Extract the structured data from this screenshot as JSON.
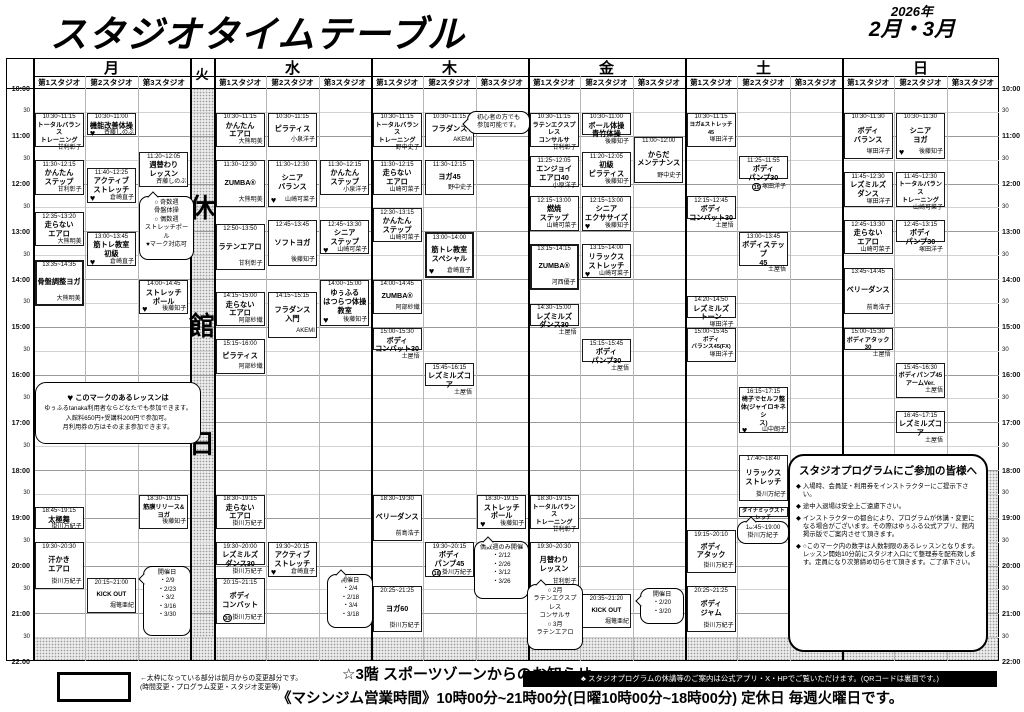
{
  "header": {
    "title": "スタジオタイムテーブル",
    "year": "2026年",
    "months": "2月・3月"
  },
  "timetable": {
    "studio_labels": [
      "第1スタジオ",
      "第2スタジオ",
      "第3スタジオ"
    ],
    "days": [
      "月",
      "火",
      "水",
      "木",
      "金",
      "土",
      "日"
    ],
    "closed_day": "火",
    "closed_day_label": "休館日",
    "time_labels": [
      "10:00",
      "30",
      "11:00",
      "30",
      "12:00",
      "30",
      "13:00",
      "30",
      "14:00",
      "30",
      "15:00",
      "30",
      "16:00",
      "30",
      "17:00",
      "30",
      "18:00",
      "30",
      "19:00",
      "30",
      "20:00",
      "30",
      "21:00",
      "30",
      "22:00"
    ],
    "classes": [
      {
        "day": "月",
        "studio": 1,
        "time": "10:30~11:15",
        "name": [
          "トータルバランス",
          "トレーニング"
        ],
        "teacher": "甘利彰子"
      },
      {
        "day": "月",
        "studio": 1,
        "time": "11:30~12:15",
        "name": [
          "かんたん",
          "ステップ"
        ],
        "teacher": "甘利彰子"
      },
      {
        "day": "月",
        "studio": 1,
        "time": "12:35~13:20",
        "name": [
          "走らない",
          "エアロ"
        ],
        "teacher": "大熊明美"
      },
      {
        "day": "月",
        "studio": 1,
        "time": "13:35~14:35",
        "name": [
          "骨盤調整ヨガ"
        ],
        "teacher": "大熊明美",
        "bold": true
      },
      {
        "day": "月",
        "studio": 1,
        "time": "18:45~19:15",
        "name": [
          "太極舞"
        ],
        "teacher": "掛川万紀子"
      },
      {
        "day": "月",
        "studio": 1,
        "time": "19:30~20:30",
        "name": [
          "汗かき",
          "エアロ"
        ],
        "teacher": "掛川万紀子"
      },
      {
        "day": "月",
        "studio": 2,
        "time": "10:30~11:00",
        "name": [
          "機能改善体操"
        ],
        "teacher": "斉藤しのぶ",
        "heart": true
      },
      {
        "day": "月",
        "studio": 2,
        "time": "11:40~12:25",
        "name": [
          "アクティブ",
          "ストレッチ"
        ],
        "teacher": "倉崎直子",
        "heart": true
      },
      {
        "day": "月",
        "studio": 2,
        "time": "13:00~13:45",
        "name": [
          "筋トレ教室",
          "初級"
        ],
        "teacher": "倉崎直子",
        "heart": true
      },
      {
        "day": "月",
        "studio": 2,
        "time": "20:15~21:00",
        "name": [
          "KICK OUT"
        ],
        "teacher": "堀篭亜紀"
      },
      {
        "day": "月",
        "studio": 3,
        "time": "11:20~12:05",
        "name": [
          "週替わり",
          "レッスン"
        ],
        "teacher": "斉藤しのぶ"
      },
      {
        "day": "月",
        "studio": 3,
        "time": "14:00~14:45",
        "name": [
          "ストレッチ",
          "ポール"
        ],
        "teacher": "後藤知子",
        "heart": true
      },
      {
        "day": "月",
        "studio": 3,
        "time": "18:30~19:15",
        "name": [
          "筋膜リリース&ヨガ"
        ],
        "teacher": "後藤知子"
      },
      {
        "day": "水",
        "studio": 1,
        "time": "10:30~11:15",
        "name": [
          "かんたん",
          "エアロ"
        ],
        "teacher": "大熊明美"
      },
      {
        "day": "水",
        "studio": 1,
        "time": "11:30~12:30",
        "name": [
          "ZUMBA®"
        ],
        "teacher": "大熊明美"
      },
      {
        "day": "水",
        "studio": 1,
        "time": "12:50~13:50",
        "name": [
          "ラテンエアロ"
        ],
        "teacher": "甘利彰子"
      },
      {
        "day": "水",
        "studio": 1,
        "time": "14:15~15:00",
        "name": [
          "走らない",
          "エアロ"
        ],
        "teacher": "阿部紗織"
      },
      {
        "day": "水",
        "studio": 1,
        "time": "15:15~16:00",
        "name": [
          "ピラティス"
        ],
        "teacher": "阿部紗織"
      },
      {
        "day": "水",
        "studio": 1,
        "time": "18:30~19:15",
        "name": [
          "走らない",
          "エアロ"
        ],
        "teacher": "掛川万紀子"
      },
      {
        "day": "水",
        "studio": 1,
        "time": "19:30~20:00",
        "name": [
          "レズミルズ",
          "ダンス30"
        ],
        "teacher": "掛川万紀子"
      },
      {
        "day": "水",
        "studio": 1,
        "time": "20:15~21:15",
        "name": [
          "ボディ",
          "コンバット"
        ],
        "teacher": "掛川万紀子",
        "cap": 30
      },
      {
        "day": "水",
        "studio": 2,
        "time": "10:30~11:15",
        "name": [
          "ピラティス"
        ],
        "teacher": "小泉洋子"
      },
      {
        "day": "水",
        "studio": 2,
        "time": "11:30~12:30",
        "name": [
          "シニア",
          "バランス"
        ],
        "teacher": "山崎可菜子",
        "heart": true
      },
      {
        "day": "水",
        "studio": 2,
        "time": "12:45~13:45",
        "name": [
          "ソフトヨガ"
        ],
        "teacher": "後藤知子"
      },
      {
        "day": "水",
        "studio": 2,
        "time": "14:15~15:15",
        "name": [
          "フラダンス",
          "入門"
        ],
        "teacher": "AKEMI"
      },
      {
        "day": "水",
        "studio": 2,
        "time": "19:30~20:15",
        "name": [
          "アクティブ",
          "ストレッチ"
        ],
        "teacher": "倉崎直子",
        "heart": true
      },
      {
        "day": "水",
        "studio": 3,
        "time": "11:30~12:15",
        "name": [
          "かんたん",
          "ステップ"
        ],
        "teacher": "小泉洋子"
      },
      {
        "day": "水",
        "studio": 3,
        "time": "12:45~13:30",
        "name": [
          "シニア",
          "ステップ"
        ],
        "teacher": "山崎可菜子",
        "heart": true
      },
      {
        "day": "水",
        "studio": 3,
        "time": "14:00~15:00",
        "name": [
          "ゆぅふる",
          "はつらつ体操",
          "教室"
        ],
        "teacher": "後藤知子",
        "heart": true
      },
      {
        "day": "木",
        "studio": 1,
        "time": "10:30~11:15",
        "name": [
          "トータルバランス",
          "トレーニング"
        ],
        "teacher": "野中史子"
      },
      {
        "day": "木",
        "studio": 1,
        "time": "11:30~12:15",
        "name": [
          "走らない",
          "エアロ"
        ],
        "teacher": "山崎可菜子"
      },
      {
        "day": "木",
        "studio": 1,
        "time": "12:30~13:15",
        "name": [
          "かんたん",
          "ステップ"
        ],
        "teacher": "山崎可菜子"
      },
      {
        "day": "木",
        "studio": 1,
        "time": "14:00~14:45",
        "name": [
          "ZUMBA®"
        ],
        "teacher": "阿部紗織"
      },
      {
        "day": "木",
        "studio": 1,
        "time": "15:00~15:30",
        "name": [
          "ボディ",
          "コンバット30"
        ],
        "teacher": "土屋悟"
      },
      {
        "day": "木",
        "studio": 1,
        "time": "18:30~19:30",
        "name": [
          "ベリーダンス"
        ],
        "teacher": "前島浩子"
      },
      {
        "day": "木",
        "studio": 1,
        "time": "20:25~21:25",
        "name": [
          "ヨガ60"
        ],
        "teacher": "掛川万紀子"
      },
      {
        "day": "木",
        "studio": 2,
        "time": "10:30~11:15",
        "name": [
          "フラダンス"
        ],
        "teacher": "AKEMI"
      },
      {
        "day": "木",
        "studio": 2,
        "time": "11:30~12:15",
        "name": [
          "ヨガ45"
        ],
        "teacher": "野中史子"
      },
      {
        "day": "木",
        "studio": 2,
        "time": "13:00~14:00",
        "name": [
          "筋トレ教室",
          "スペシャル"
        ],
        "teacher": "倉崎直子",
        "heart": true,
        "bold": true
      },
      {
        "day": "木",
        "studio": 2,
        "time": "15:45~16:15",
        "name": [
          "レズミルズコア"
        ],
        "teacher": "土屋悟"
      },
      {
        "day": "木",
        "studio": 2,
        "time": "19:30~20:15",
        "name": [
          "ボディ",
          "パンプ45"
        ],
        "teacher": "掛川万紀子",
        "cap": 18
      },
      {
        "day": "木",
        "studio": 3,
        "time": "18:30~19:15",
        "name": [
          "ストレッチ",
          "ポール"
        ],
        "teacher": "後藤知子",
        "heart": true
      },
      {
        "day": "金",
        "studio": 1,
        "time": "10:30~11:15",
        "name": [
          "ラテンエクスプレス",
          "コンサルサ"
        ],
        "teacher": "甘利彰子"
      },
      {
        "day": "金",
        "studio": 1,
        "time": "11:25~12:05",
        "name": [
          "エンジョイ",
          "エアロ40"
        ],
        "teacher": "小原洋子"
      },
      {
        "day": "金",
        "studio": 1,
        "time": "12:15~13:00",
        "name": [
          "燃焼",
          "ステップ"
        ],
        "teacher": "山崎可菜子"
      },
      {
        "day": "金",
        "studio": 1,
        "time": "13:15~14:15",
        "name": [
          "ZUMBA®"
        ],
        "teacher": "河西優子",
        "bold": true
      },
      {
        "day": "金",
        "studio": 1,
        "time": "14:30~15:00",
        "name": [
          "レズミルズ",
          "ダンス30"
        ],
        "teacher": "土屋悟"
      },
      {
        "day": "金",
        "studio": 1,
        "time": "18:30~19:15",
        "name": [
          "トータルバランス",
          "トレーニング"
        ],
        "teacher": "甘利彰子"
      },
      {
        "day": "金",
        "studio": 1,
        "time": "19:30~20:30",
        "name": [
          "月替わり",
          "レッスン"
        ],
        "teacher": "甘利彰子"
      },
      {
        "day": "金",
        "studio": 2,
        "time": "10:30~11:00",
        "name": [
          "ボール体操",
          "青竹体操"
        ],
        "teacher": "後藤知子"
      },
      {
        "day": "金",
        "studio": 2,
        "time": "11:20~12:05",
        "name": [
          "初級",
          "ピラティス"
        ],
        "teacher": "後藤知子"
      },
      {
        "day": "金",
        "studio": 2,
        "time": "12:15~13:00",
        "name": [
          "シニア",
          "エクササイズ"
        ],
        "teacher": "後藤知子",
        "heart": true
      },
      {
        "day": "金",
        "studio": 2,
        "time": "13:15~14:00",
        "name": [
          "リラックス",
          "ストレッチ"
        ],
        "teacher": "山崎可菜子",
        "heart": true
      },
      {
        "day": "金",
        "studio": 2,
        "time": "15:15~15:45",
        "name": [
          "ボディ",
          "パンプ30"
        ],
        "teacher": "土屋悟"
      },
      {
        "day": "金",
        "studio": 2,
        "time": "20:35~21:20",
        "name": [
          "KICK OUT"
        ],
        "teacher": "堀篭亜紀"
      },
      {
        "day": "金",
        "studio": 3,
        "time": "11:00~12:00",
        "name": [
          "からだ",
          "メンテナンス"
        ],
        "teacher": "野中史子"
      },
      {
        "day": "土",
        "studio": 1,
        "time": "10:30~11:15",
        "name": [
          "ヨガ&ストレッチ45"
        ],
        "teacher": "塚田洋子"
      },
      {
        "day": "土",
        "studio": 1,
        "time": "12:15~12:45",
        "name": [
          "ボディ",
          "コンバット30"
        ],
        "teacher": "土屋悟"
      },
      {
        "day": "土",
        "studio": 1,
        "time": "14:20~14:50",
        "name": [
          "レズミルズ",
          "トーン"
        ],
        "teacher": "塚田洋子"
      },
      {
        "day": "土",
        "studio": 1,
        "time": "15:00~15:45",
        "name": [
          "ボディ",
          "バランス45(FX)"
        ],
        "teacher": "塚田洋子"
      },
      {
        "day": "土",
        "studio": 1,
        "time": "19:15~20:10",
        "name": [
          "ボディ",
          "アタック"
        ],
        "teacher": "掛川万紀子"
      },
      {
        "day": "土",
        "studio": 1,
        "time": "20:25~21:25",
        "name": [
          "ボディ",
          "ジャム"
        ],
        "teacher": "掛川万紀子"
      },
      {
        "day": "土",
        "studio": 2,
        "time": "11:25~11:55",
        "name": [
          "ボディ",
          "パンプ30"
        ],
        "teacher": "塚田洋子",
        "cap": 15
      },
      {
        "day": "土",
        "studio": 2,
        "time": "13:00~13:45",
        "name": [
          "ボディステップ",
          "45"
        ],
        "teacher": "土屋悟"
      },
      {
        "day": "土",
        "studio": 2,
        "time": "16:15~17:15",
        "name": [
          "椅子でセルフ整",
          "体(ジャイロキネシ",
          "ス)"
        ],
        "teacher": "山中朗子",
        "heart": true
      },
      {
        "day": "土",
        "studio": 2,
        "time": "17:40~18:40",
        "name": [
          "リラックス",
          "ストレッチ"
        ],
        "teacher": "掛川万紀子"
      },
      {
        "day": "土",
        "studio": 2,
        "time": "18:45~19:00",
        "name": [
          "ダイナミックストレッチ"
        ],
        "teacher": "掛川万紀子",
        "mini": true
      },
      {
        "day": "日",
        "studio": 1,
        "time": "10:30~11:30",
        "name": [
          "ボディ",
          "バランス"
        ],
        "teacher": "塚田洋子"
      },
      {
        "day": "日",
        "studio": 1,
        "time": "11:45~12:30",
        "name": [
          "レズミルズ",
          "ダンス"
        ],
        "teacher": "塚田洋子"
      },
      {
        "day": "日",
        "studio": 1,
        "time": "12:45~13:30",
        "name": [
          "走らない",
          "エアロ"
        ],
        "teacher": "山崎可菜子"
      },
      {
        "day": "日",
        "studio": 1,
        "time": "13:45~14:45",
        "name": [
          "ベリーダンス"
        ],
        "teacher": "前島浩子"
      },
      {
        "day": "日",
        "studio": 1,
        "time": "15:00~15:30",
        "name": [
          "ボディアタック30"
        ],
        "teacher": "土屋悟"
      },
      {
        "day": "日",
        "studio": 2,
        "time": "10:30~11:30",
        "name": [
          "シニア",
          "ヨガ"
        ],
        "teacher": "後藤知子",
        "heart": true
      },
      {
        "day": "日",
        "studio": 2,
        "time": "11:45~12:30",
        "name": [
          "トータルバランス",
          "トレーニング"
        ],
        "teacher": "山崎可菜子"
      },
      {
        "day": "日",
        "studio": 2,
        "time": "12:45~13:15",
        "name": [
          "ボディ",
          "パンプ30"
        ],
        "teacher": "塚田洋子"
      },
      {
        "day": "日",
        "studio": 2,
        "time": "15:45~16:30",
        "name": [
          "ボディパンプ45",
          "アームVer."
        ],
        "teacher": "土屋悟"
      },
      {
        "day": "日",
        "studio": 2,
        "time": "16:45~17:15",
        "name": [
          "レズミルズコア"
        ],
        "teacher": "土屋悟"
      }
    ],
    "callouts": [
      {
        "id": "mon-weekly-lesson",
        "x": 139,
        "y": 196,
        "w": 55,
        "h": 64,
        "tail": "top",
        "lines": [
          "○ 奇数週",
          "骨盤体操",
          "○ 偶数週",
          "ストレッチポール",
          "♥マーク対応可"
        ]
      },
      {
        "id": "mon-kickout-dates",
        "x": 143,
        "y": 566,
        "w": 48,
        "h": 70,
        "tail": "left",
        "lines": [
          "開催日",
          "・2/9",
          "・2/23",
          "・3/2",
          "・3/16",
          "・3/30"
        ]
      },
      {
        "id": "thu-hula-note",
        "x": 467,
        "y": 111,
        "w": 63,
        "h": 22,
        "tail": "left",
        "lines": [
          "初心者の方でも",
          "参加可能です。"
        ]
      },
      {
        "id": "wed-active-dates",
        "x": 327,
        "y": 574,
        "w": 46,
        "h": 54,
        "tail": "top",
        "lines": [
          "開催日",
          "・2/4",
          "・2/18",
          "・3/4",
          "・3/18"
        ]
      },
      {
        "id": "thu-pole-dates",
        "x": 474,
        "y": 541,
        "w": 55,
        "h": 58,
        "tail": "top",
        "lines": [
          "偶数週のみ開催",
          "・2/12",
          "・2/26",
          "・3/12",
          "・3/26"
        ]
      },
      {
        "id": "fri-monthly-lesson",
        "x": 527,
        "y": 584,
        "w": 56,
        "h": 66,
        "tail": "top",
        "lines": [
          "○ 2月",
          "ラテンエクスプレス",
          "コンサルサ",
          "○ 3月",
          "ラテンエアロ"
        ]
      },
      {
        "id": "fri-kickout-dates",
        "x": 640,
        "y": 588,
        "w": 44,
        "h": 36,
        "tail": "left",
        "lines": [
          "開催日",
          "・2/20",
          "・3/20"
        ]
      },
      {
        "id": "sat-dynamic-time",
        "x": 737,
        "y": 521,
        "w": 52,
        "h": 22,
        "tail": "top",
        "lines": [
          "18:45~19:00",
          "掛川万紀子"
        ]
      }
    ]
  },
  "heart_note": {
    "heart": "♥",
    "lines": [
      "このマークのあるレッスンは",
      "ゆぅふるtanaka利用者ならどなたでも参加できます。",
      "入館料650円+受講料200円で参加可。",
      "月利用券の方はそのまま参加できます。"
    ]
  },
  "participant_notice": {
    "title": "スタジオプログラムにご参加の皆様へ",
    "bullets": [
      "入場時、会員証・利用券をインストラクターにご提示下さい。",
      "途中入退場は安全上ご遠慮下さい。",
      "インストラクターの都合により、プログラムが休講・変更になる場合がございます。その際はゆぅふる公式アプリ、館内掲示版でご案内させて頂きます。",
      "○このマーク内の数字は人数制限のあるレッスンとなります。レッスン開始10分前にスタジオ入口にて整理券を配布致します。定員になり次第締め切らせて頂きます。ご了承下さい。"
    ]
  },
  "legend": {
    "line1": "←太枠になっている部分は前月からの変更部分です。",
    "line2": "(時間変更・プログラム変更・スタジオ変更等)"
  },
  "footer": {
    "sports_zone": "☆3階 スポーツゾーンからのお知らせ",
    "notice_bar": "スタジオプログラムの休講等のご案内は公式アプリ・X・HPでご覧いただけます。(QRコードは裏面です。)",
    "machine_gym": "《マシンジム営業時間》10時00分~21時00分(日曜10時00分~18時00分) 定休日 毎週火曜日です。"
  }
}
